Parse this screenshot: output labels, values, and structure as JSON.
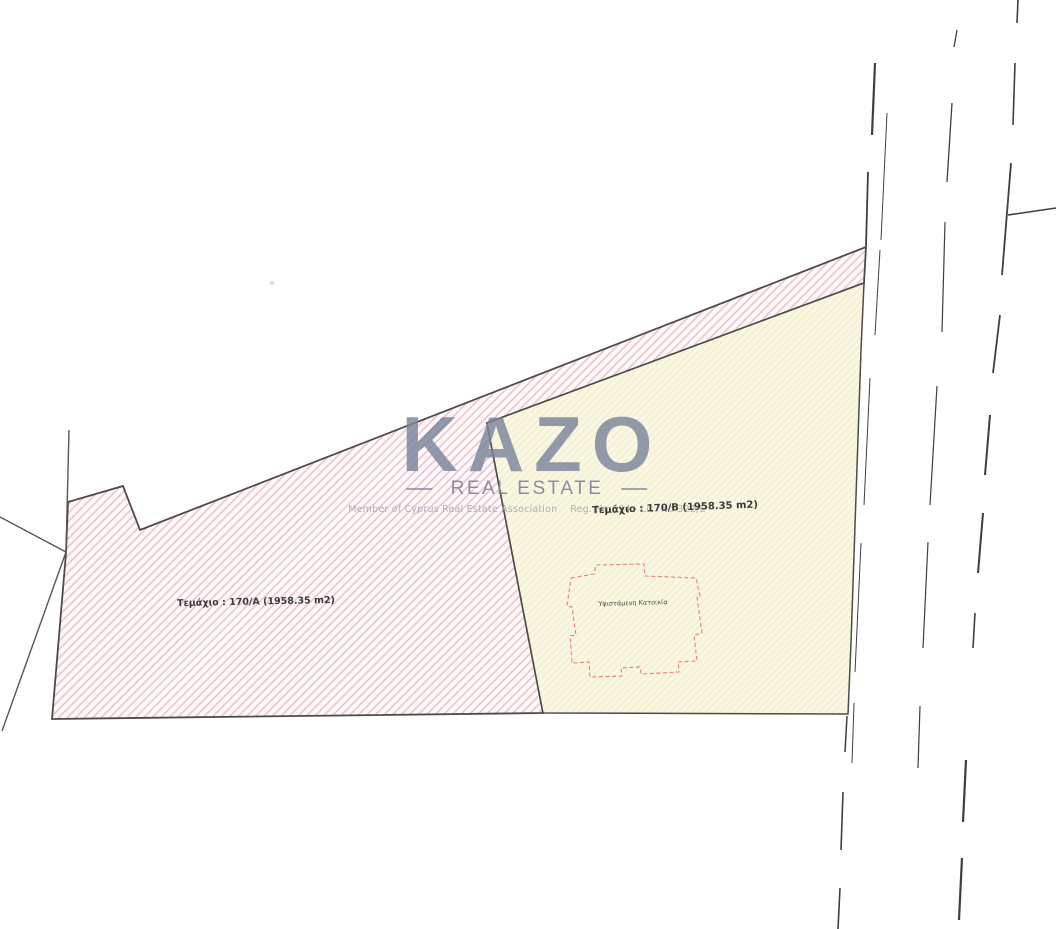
{
  "title": "Cadastral site plan scan",
  "watermark": {
    "brand": "KAZO",
    "subtitle": "REAL ESTATE",
    "membership": "Member of Cyprus Real Estate Association    Reg. No 694 - Lic. No 322/E"
  },
  "parcels": [
    {
      "id": "170/A",
      "label": "Τεμάχιο : 170/A (1958.35 m2)",
      "area_m2": "1958.35",
      "fill": "pink-hatch"
    },
    {
      "id": "170/B",
      "label": "Τεμάχιο : 170/B (1958.35 m2)",
      "area_m2": "1958.35",
      "fill": "yellow-hatch"
    }
  ],
  "building": {
    "label": "Υφιστάμενη Κατοικία"
  },
  "colors": {
    "pink_bg": "#fefafa",
    "pink_hatch": "#ebc2cc",
    "yellow_bg": "#fbf8e2",
    "yellow_hatch": "#efecd2",
    "parcel_outline": "#4e4a47",
    "boundary_line": "#5a5550",
    "road_line": "#3e3e44",
    "building_outline": "#e08472",
    "watermark": "#7a849c"
  },
  "geometry": {
    "parcel_a_points": "68,502 123,486 140,530 866,247 864,283 487,423 543,713 52,719 66,553",
    "parcel_b_points": "487,423 864,283 861,350 851,643 848,714 543,713",
    "building_points": "571,578 594,574 596,565 644,564 645,576 696,578 700,596 697,597 702,633 694,635 697,661 678,662 679,672 641,674 640,667 621,668 622,676 590,677 589,662 572,663 570,636 576,635 572,607 567,606",
    "boundary_lines": [
      [
        0,
        517,
        66,
        552
      ],
      [
        69,
        430,
        66,
        552
      ],
      [
        66,
        552,
        2,
        731
      ]
    ],
    "road_dashes": [
      [
        875,
        63,
        872,
        135,
        2.2
      ],
      [
        868,
        172,
        866,
        246,
        1.8
      ],
      [
        847,
        716,
        845,
        752,
        1.5
      ],
      [
        843,
        792,
        841,
        850,
        1.6
      ],
      [
        840,
        888,
        838,
        929,
        1.6
      ],
      [
        887,
        113,
        881,
        240,
        1.0
      ],
      [
        880,
        250,
        875,
        335,
        1.0
      ],
      [
        870,
        378,
        864,
        505,
        1.0
      ],
      [
        861,
        543,
        855,
        672,
        1.0
      ],
      [
        854,
        703,
        852,
        763,
        1.0
      ],
      [
        957,
        30,
        954,
        47,
        1.3
      ],
      [
        952,
        103,
        947,
        182,
        1.3
      ],
      [
        945,
        222,
        942,
        332,
        1.2
      ],
      [
        937,
        386,
        930,
        505,
        1.2
      ],
      [
        928,
        542,
        923,
        648,
        1.2
      ],
      [
        920,
        706,
        918,
        768,
        1.2
      ],
      [
        1018,
        0,
        1017,
        23,
        1.6
      ],
      [
        1015,
        63,
        1013,
        125,
        1.6
      ],
      [
        1011,
        163,
        1002,
        275,
        1.8
      ],
      [
        1000,
        315,
        993,
        373,
        1.8
      ],
      [
        990,
        415,
        985,
        475,
        2.0
      ],
      [
        983,
        513,
        978,
        573,
        2.0
      ],
      [
        975,
        613,
        973,
        648,
        1.6
      ],
      [
        966,
        760,
        963,
        822,
        2.2
      ],
      [
        962,
        858,
        959,
        920,
        2.2
      ],
      [
        1008,
        215,
        1056,
        208,
        1.5
      ]
    ]
  }
}
